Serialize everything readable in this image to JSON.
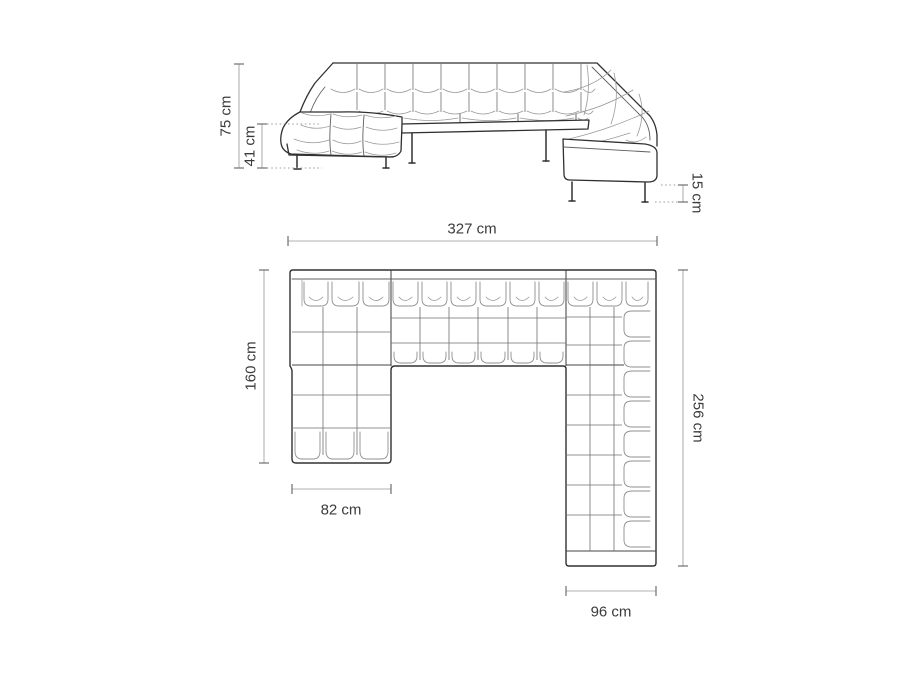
{
  "diagram": {
    "type": "corner-sofa-dimension-technical-drawing",
    "views": {
      "perspective": {
        "name": "perspective-view",
        "dimensions": {
          "total_height": "75 cm",
          "seat_height": "41 cm",
          "leg_height": "15 cm"
        }
      },
      "plan": {
        "name": "top-plan-view",
        "dimensions": {
          "total_width": "327 cm",
          "left_depth": "160 cm",
          "chaise_width": "82 cm",
          "right_depth": "256 cm",
          "right_arm_width": "96 cm"
        }
      }
    },
    "colors": {
      "background": "#ffffff",
      "outline": "#303030",
      "detail_line": "#9a9a9a",
      "grid_line": "#6f6f6f",
      "dimension_line": "#b0b0b0",
      "dimension_tick": "#6f6f6f",
      "label_text": "#3b3b3b"
    }
  }
}
